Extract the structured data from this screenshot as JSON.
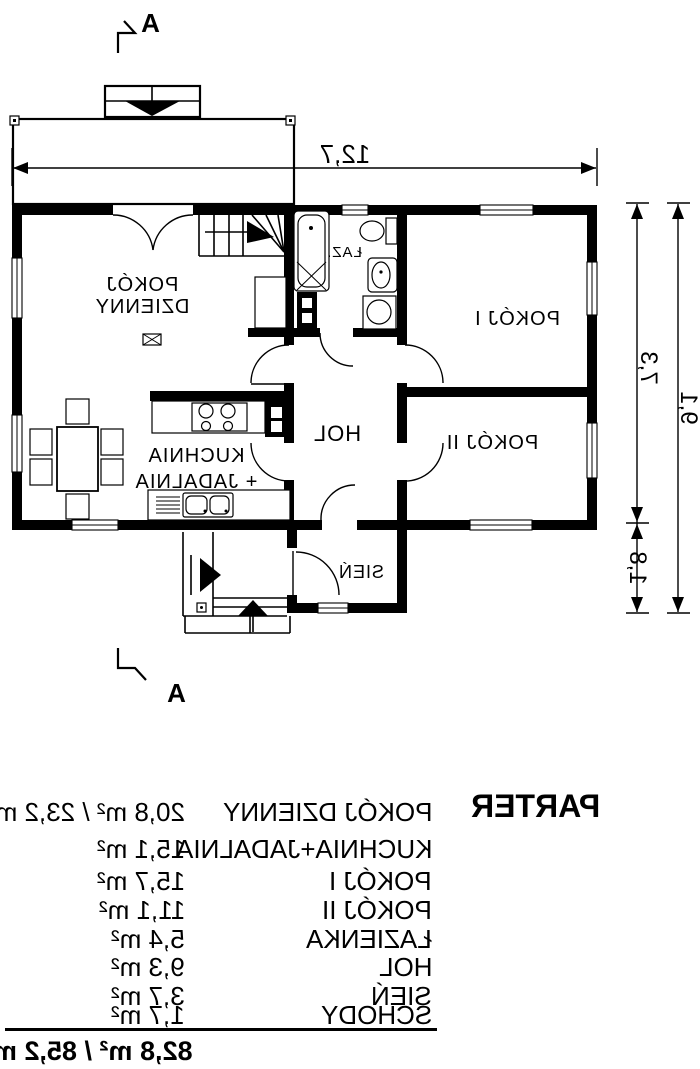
{
  "plan": {
    "section_label_top": "A",
    "section_label_bottom": "A",
    "dim_width": "12,7",
    "dim_height_upper": "7,3",
    "dim_height_lower": "1,8",
    "dim_height_total": "9,1",
    "rooms": {
      "living_line1": "POKÓJ",
      "living_line2": "DZIENNY",
      "kitchen_line1": "KUCHNIA",
      "kitchen_line2": "+ JADALNIA",
      "bath": "ŁAZ.",
      "hol": "HOL",
      "room1": "POKÓJ I",
      "room2": "POKÓJ II",
      "sien": "SIEŃ"
    }
  },
  "legend": {
    "title": "PARTER",
    "rows": [
      {
        "name": "POKÓJ DZIENNY",
        "value": "20,8 m² / 23,2 m²"
      },
      {
        "name": "KUCHNIA+JADALNIA",
        "value": "15,1 m²"
      },
      {
        "name": "POKÓJ I",
        "value": "15,7 m²"
      },
      {
        "name": "POKÓJ II",
        "value": "11,1 m²"
      },
      {
        "name": "ŁAZIENKA",
        "value": "5,4 m²"
      },
      {
        "name": "HOL",
        "value": "9,3 m²"
      },
      {
        "name": "SIEŃ",
        "value": "3,7 m²"
      },
      {
        "name": "SCHODY",
        "value": "1,7 m²"
      }
    ],
    "total": "82,8 m² / 85,2 m²"
  }
}
